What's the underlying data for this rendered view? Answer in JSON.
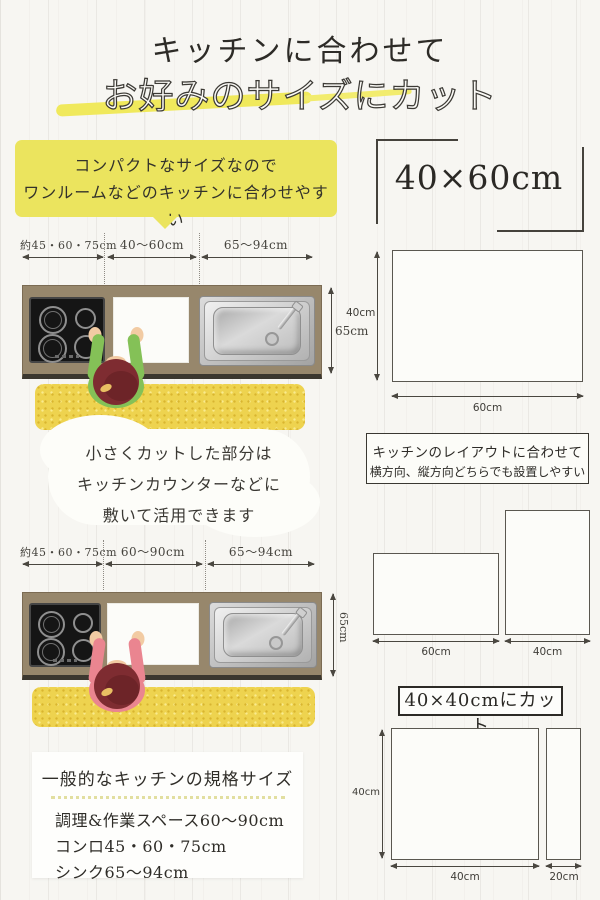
{
  "title": {
    "line1": "キッチンに合わせて",
    "line2": "お好みのサイズにカット"
  },
  "bubble": {
    "line1": "コンパクトなサイズなので",
    "line2": "ワンルームなどのキッチンに合わせやすい"
  },
  "diagram1": {
    "dims": [
      "約45・60・75cm",
      "40〜60cm",
      "65〜94cm"
    ],
    "depth": "65cm",
    "person_shirt": "#84c157"
  },
  "cloud": {
    "line1": "小さくカットした部分は",
    "line2": "キッチンカウンターなどに",
    "line3": "敷いて活用できます"
  },
  "diagram2": {
    "dims": [
      "約45・60・75cm",
      "60〜90cm",
      "65〜94cm"
    ],
    "depth": "65cm",
    "person_shirt": "#ea8590"
  },
  "spec_box": {
    "title": "一般的なキッチンの規格サイズ",
    "lines": [
      "調理&作業スペース60〜90cm",
      "コンロ45・60・75cm",
      "シンク65〜94cm"
    ]
  },
  "featured": {
    "size_label": "40×60cm",
    "height_label": "40cm",
    "width_label": "60cm"
  },
  "layout_note": {
    "line1": "キッチンのレイアウトに合わせて",
    "line2": "横方向、縦方向どちらでも設置しやすい",
    "landscape_width": "60cm",
    "portrait_width": "40cm"
  },
  "cut_section": {
    "title": "40×40cmにカット",
    "height_label": "40cm",
    "square_width": "40cm",
    "strip_width": "20cm"
  },
  "colors": {
    "accent_yellow": "#ebe45e",
    "marker_yellow": "#f0e95c",
    "mat_yellow": "#eed34f",
    "counter_brown": "#97876c",
    "hair": "#7e2c31",
    "skin": "#f2cba3"
  }
}
